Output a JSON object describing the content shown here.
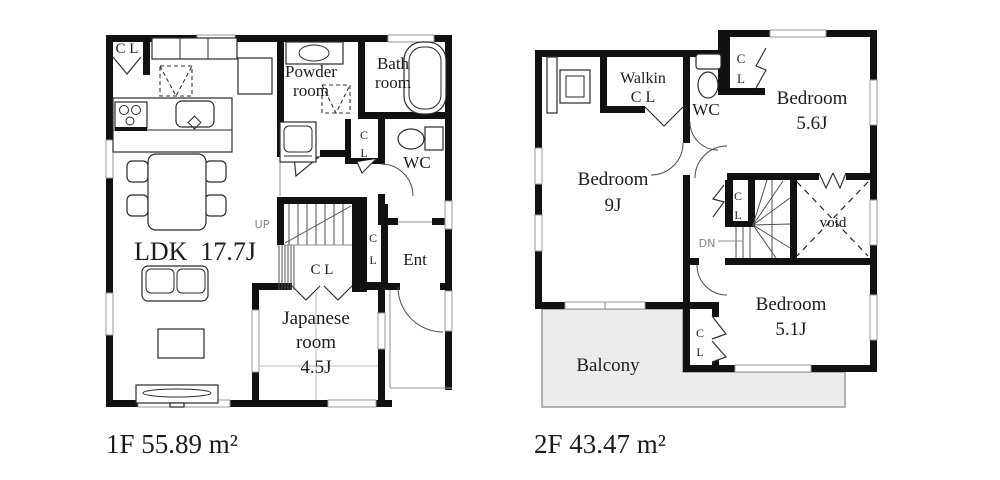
{
  "colors": {
    "wall": "#111111",
    "ink": "#1c1c1c",
    "gray": "#83838e",
    "balcony": "#ececec",
    "faint": "#999999"
  },
  "f1": {
    "area": "1F 55.89 m²",
    "cl_top": "C L",
    "powder": [
      "Powder",
      "room"
    ],
    "bath": [
      "Bath",
      "room"
    ],
    "cl_mid": [
      "C",
      "L"
    ],
    "wc": "WC",
    "up": "UP",
    "ldk": "LDK  17.7J",
    "cl_stairs": "C L",
    "cl_ent": [
      "C",
      "L"
    ],
    "ent": "Ent",
    "japanese": [
      "Japanese",
      "room",
      "4.5J"
    ]
  },
  "f2": {
    "area": "2F 43.47 m²",
    "walkin": [
      "Walkin",
      "C L"
    ],
    "wc": "WC",
    "cl_ne": [
      "C",
      "L"
    ],
    "bedroom56": [
      "Bedroom",
      "5.6J"
    ],
    "bedroom9": [
      "Bedroom",
      "9J"
    ],
    "dn": "DN",
    "cl_stairs": [
      "C",
      "L"
    ],
    "void_label": "void",
    "bedroom51": [
      "Bedroom",
      "5.1J"
    ],
    "cl51": [
      "C",
      "L"
    ],
    "balcony": "Balcony"
  }
}
